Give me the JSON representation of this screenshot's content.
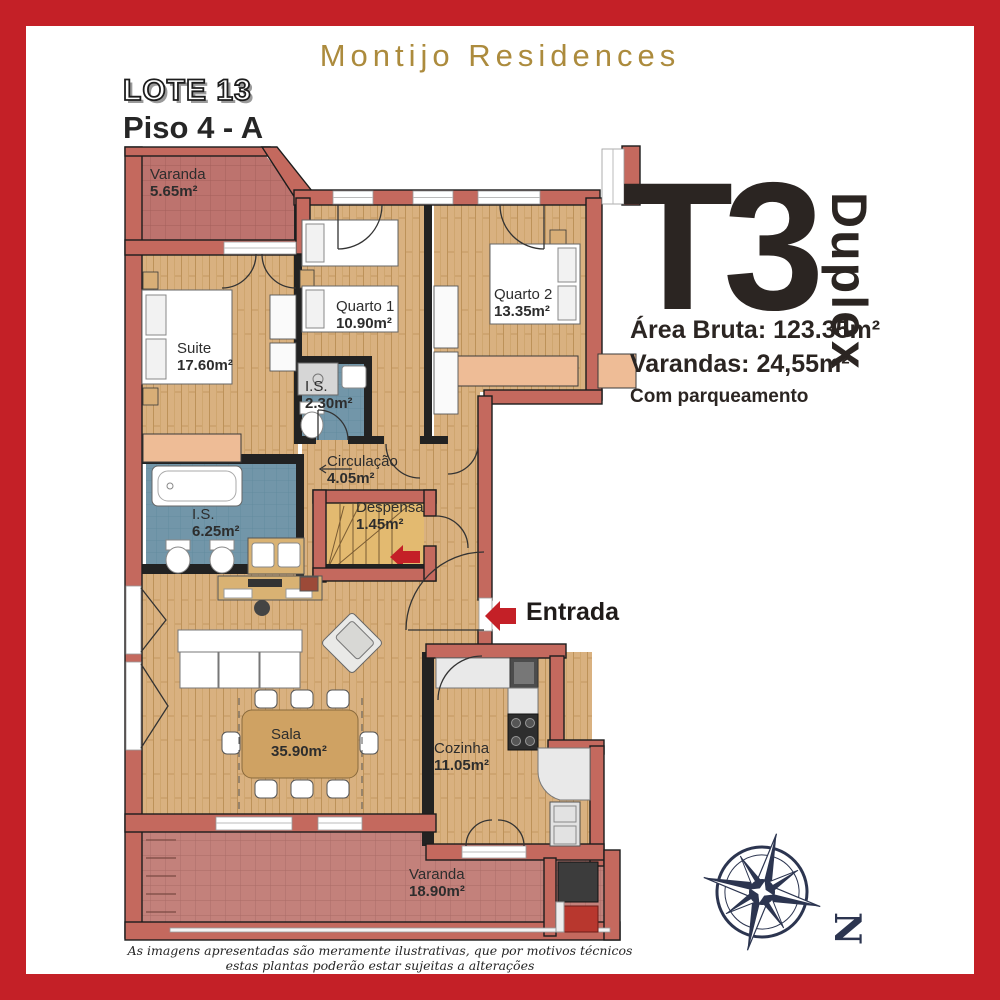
{
  "header": {
    "brand": "Montijo Residences",
    "lote": "LOTE 13",
    "piso": "Piso 4 - A"
  },
  "unit": {
    "type": "T3",
    "variant": "Duplex",
    "area_bruta": "Área Bruta: 123.35m²",
    "varandas": "Varandas: 24,55m²",
    "parking": "Com parqueamento"
  },
  "entrance": {
    "label": "Entrada"
  },
  "rooms": [
    {
      "id": "varanda-top",
      "name": "Varanda",
      "area": "5.65m²"
    },
    {
      "id": "suite",
      "name": "Suite",
      "area": "17.60m²"
    },
    {
      "id": "quarto-1",
      "name": "Quarto 1",
      "area": "10.90m²"
    },
    {
      "id": "quarto-2",
      "name": "Quarto 2",
      "area": "13.35m²"
    },
    {
      "id": "is-small",
      "name": "I.S.",
      "area": "2.30m²"
    },
    {
      "id": "circulacao",
      "name": "Circulação",
      "area": "4.05m²"
    },
    {
      "id": "is-large",
      "name": "I.S.",
      "area": "6.25m²"
    },
    {
      "id": "despensa",
      "name": "Despensa",
      "area": "1.45m²"
    },
    {
      "id": "sala",
      "name": "Sala",
      "area": "35.90m²"
    },
    {
      "id": "cozinha",
      "name": "Cozinha",
      "area": "11.05m²"
    },
    {
      "id": "varanda-bottom",
      "name": "Varanda",
      "area": "18.90m²"
    }
  ],
  "compass": {
    "north_label": "N"
  },
  "footer": {
    "disclaimer": "As imagens apresentadas são meramente ilustrativas, que por motivos técnicos estas plantas poderão estar sujeitas a alterações"
  },
  "colors": {
    "frame_red": "#c42027",
    "brand_gold": "#ac8b3d",
    "wall_salmon": "#c4695e",
    "wood_floor": "#d9b180",
    "balcony_tile": "#c3817b",
    "bath_tile": "#7296a9",
    "ink": "#2b2522",
    "compass_navy": "#2c3550",
    "arrow_red": "#c42027"
  }
}
